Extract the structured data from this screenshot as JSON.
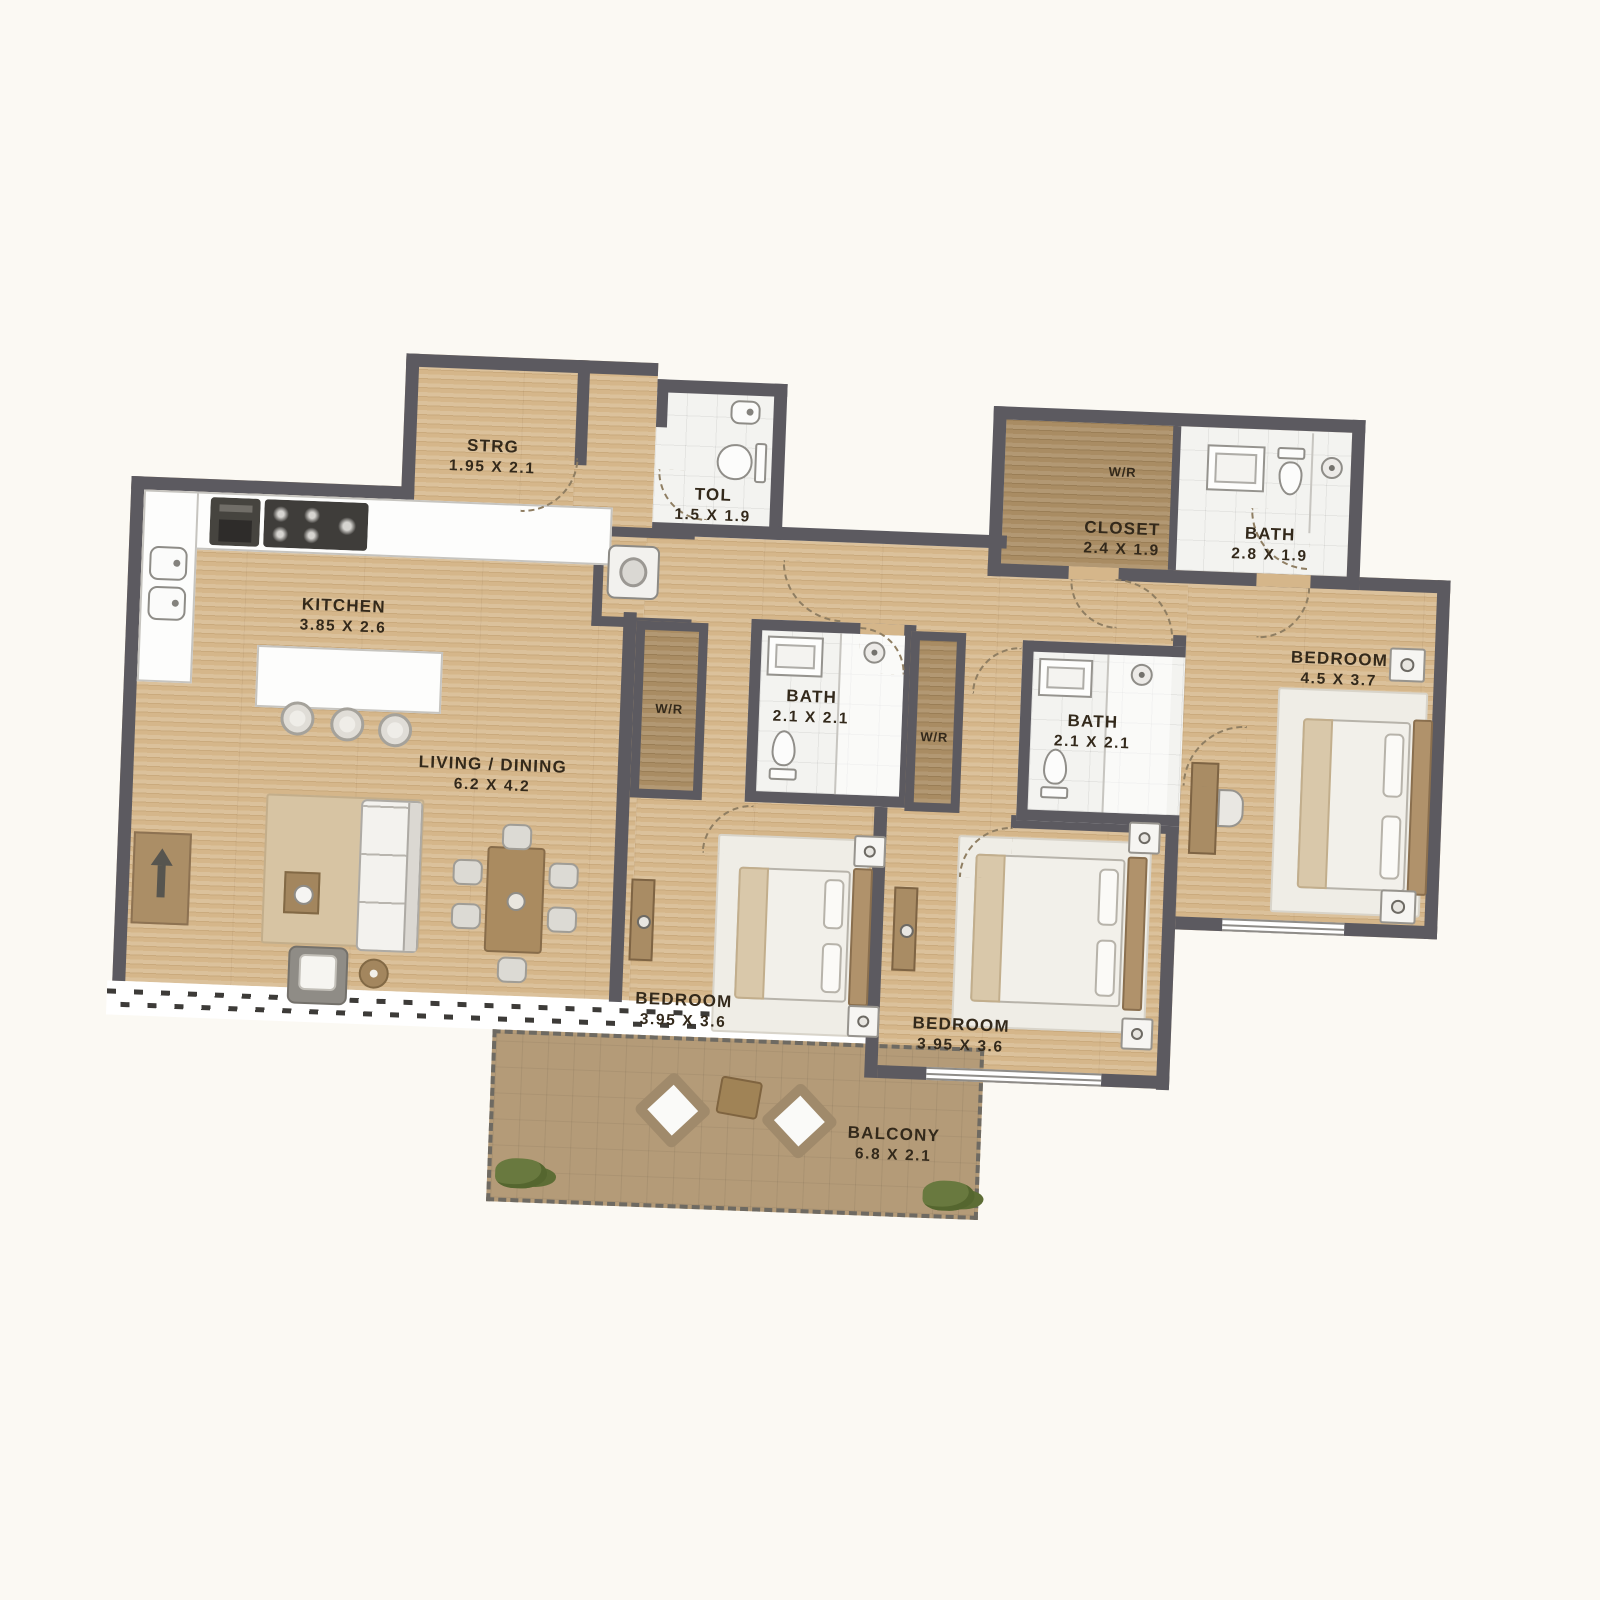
{
  "plan": {
    "type": "apartment-floor-plan",
    "wall_color": "#5c5a60",
    "wood_color": "#d5b68a",
    "tile_color": "#f3f3f0",
    "cabinet_color": "#a98c63",
    "balcony_color": "#b49b78"
  },
  "rooms": {
    "storage": {
      "name": "STRG",
      "dims": "1.95 X 2.1"
    },
    "toilet": {
      "name": "TOL",
      "dims": "1.5 X 1.9"
    },
    "wr_top": {
      "name": "W/R"
    },
    "closet": {
      "name": "CLOSET",
      "dims": "2.4 X 1.9"
    },
    "bath_top": {
      "name": "BATH",
      "dims": "2.8 X 1.9"
    },
    "kitchen": {
      "name": "KITCHEN",
      "dims": "3.85 X 2.6"
    },
    "living_dining": {
      "name": "LIVING / DINING",
      "dims": "6.2 X 4.2"
    },
    "wr_left": {
      "name": "W/R"
    },
    "bath_mid": {
      "name": "BATH",
      "dims": "2.1 X 2.1"
    },
    "wr_mid": {
      "name": "W/R"
    },
    "bath_ensuite": {
      "name": "BATH",
      "dims": "2.1 X 2.1"
    },
    "bedroom_master": {
      "name": "BEDROOM",
      "dims": "4.5 X 3.7"
    },
    "bedroom_left": {
      "name": "BEDROOM",
      "dims": "3.95 X 3.6"
    },
    "bedroom_right": {
      "name": "BEDROOM",
      "dims": "3.95 X 3.6"
    },
    "balcony": {
      "name": "BALCONY",
      "dims": "6.8 X 2.1"
    }
  }
}
